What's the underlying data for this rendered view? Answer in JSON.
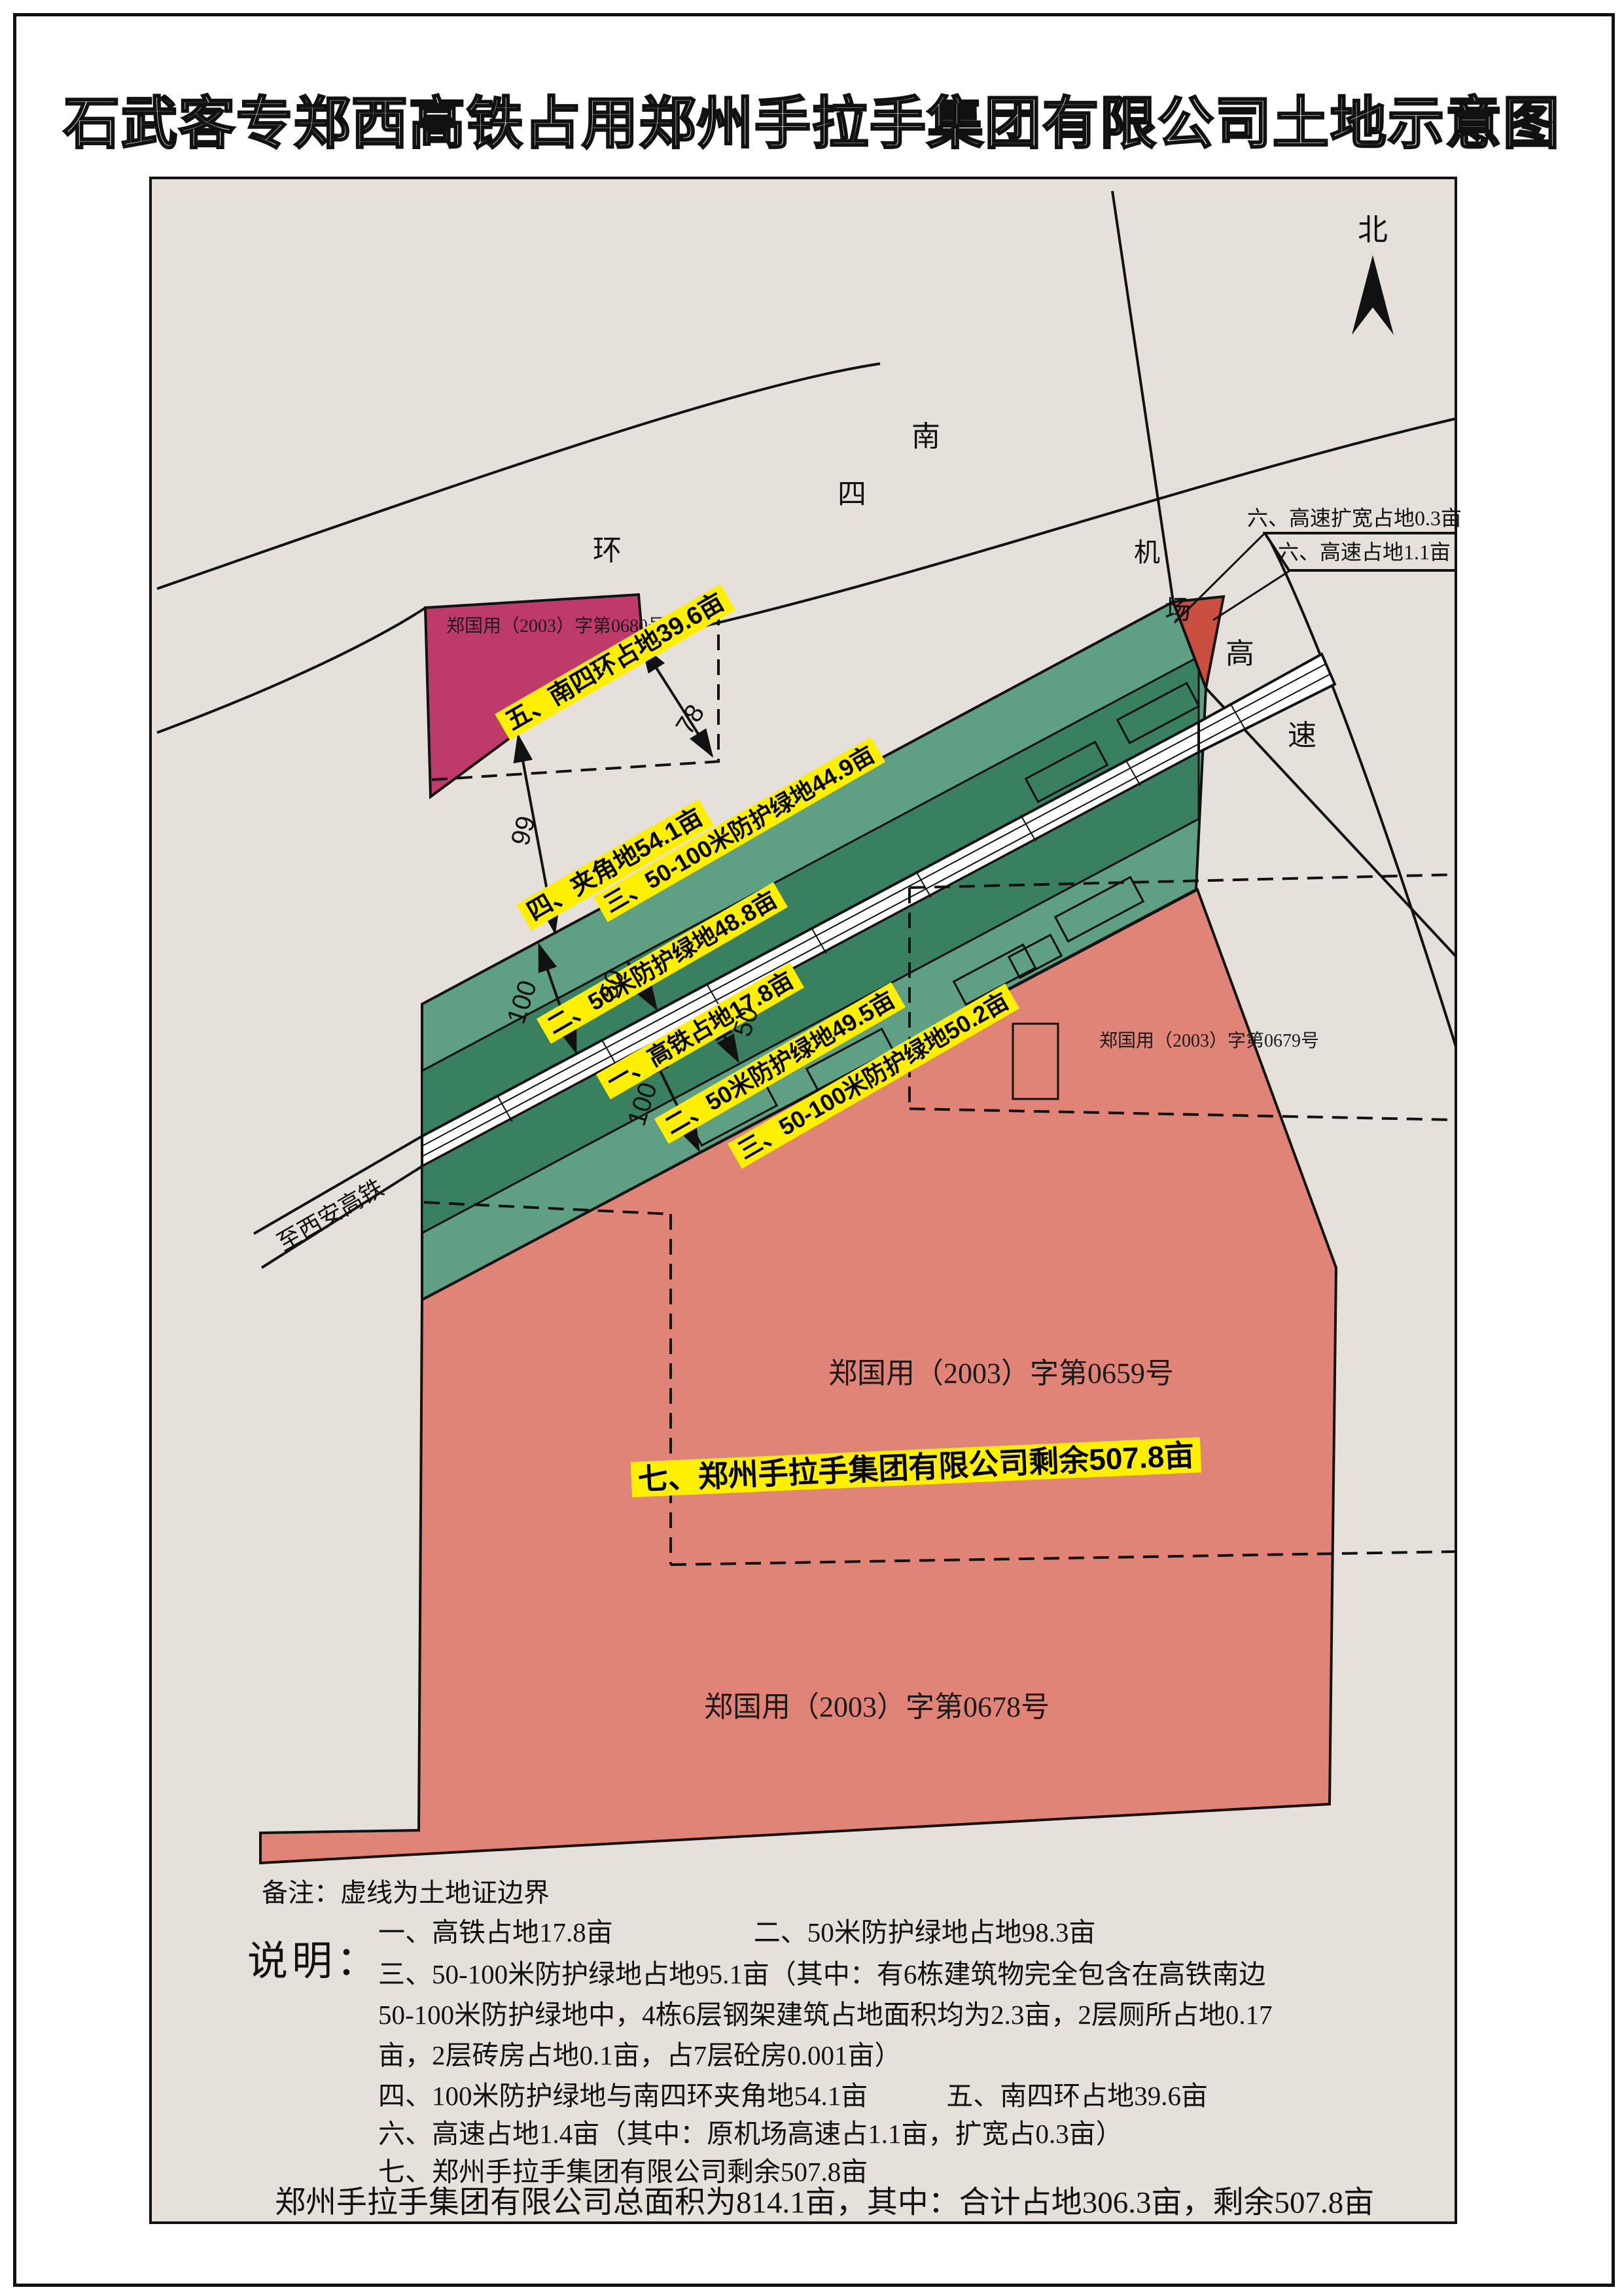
{
  "title": "石武客专郑西高铁占用郑州手拉手集团有限公司土地示意图",
  "compass": {
    "north_label": "北"
  },
  "roads": {
    "nansihuan_chars": [
      "南",
      "四",
      "环"
    ],
    "jichang_chars": [
      "机",
      "场"
    ],
    "gaosu_chars": [
      "高",
      "速"
    ],
    "railway_direction_label": "至西安高铁"
  },
  "highway_labels": {
    "widen": "六、高速扩宽占地0.3亩",
    "original": "六、高速占地1.1亩"
  },
  "area_labels": {
    "five": "五、南四环占地39.6亩",
    "four": "四、夹角地54.1亩",
    "three_north": "三、50-100米防护绿地44.9亩",
    "two_north": "二、50米防护绿地48.8亩",
    "one": "一、高铁占地17.8亩",
    "two_south": "二、50米防护绿地49.5亩",
    "three_south": "三、50-100米防护绿地50.2亩",
    "seven": "七、郑州手拉手集团有限公司剩余507.8亩"
  },
  "certificates": {
    "c0680": "郑国用（2003）字第0680号",
    "c0679": "郑国用（2003）字第0679号",
    "c0659": "郑国用（2003）字第0659号",
    "c0678": "郑国用（2003）字第0678号"
  },
  "dimensions": {
    "d78": "78",
    "d99": "99",
    "d100_north": "100",
    "d50_north": "50",
    "d50_south": "50",
    "d100_south": "100"
  },
  "notes": {
    "remark": "备注：虚线为土地证边界",
    "heading": "说明：",
    "line1a": "一、高铁占地17.8亩",
    "line1b": "二、50米防护绿地占地98.3亩",
    "line2": "三、50-100米防护绿地占地95.1亩（其中：有6栋建筑物完全包含在高铁南边",
    "line3": "50-100米防护绿地中，4栋6层钢架建筑占地面积均为2.3亩，2层厕所占地0.17",
    "line4": "亩，2层砖房占地0.1亩，占7层砼房0.001亩）",
    "line5a": "四、100米防护绿地与南四环夹角地54.1亩",
    "line5b": "五、南四环占地39.6亩",
    "line6": "六、高速占地1.4亩（其中：原机场高速占1.1亩，扩宽占0.3亩）",
    "line7": "七、郑州手拉手集团有限公司剩余507.8亩",
    "total": "郑州手拉手集团有限公司总面积为814.1亩，其中：合计占地306.3亩，剩余507.8亩"
  },
  "colors": {
    "map_bg": "#e5e1da",
    "parcel_0680": "#be3a6a",
    "green_light": "#5fa084",
    "green_dark": "#388060",
    "parcel_salmon": "#e08478",
    "highway_parcel": "#cb4f41",
    "label_yellow": "#ffef00",
    "line": "#111111"
  }
}
